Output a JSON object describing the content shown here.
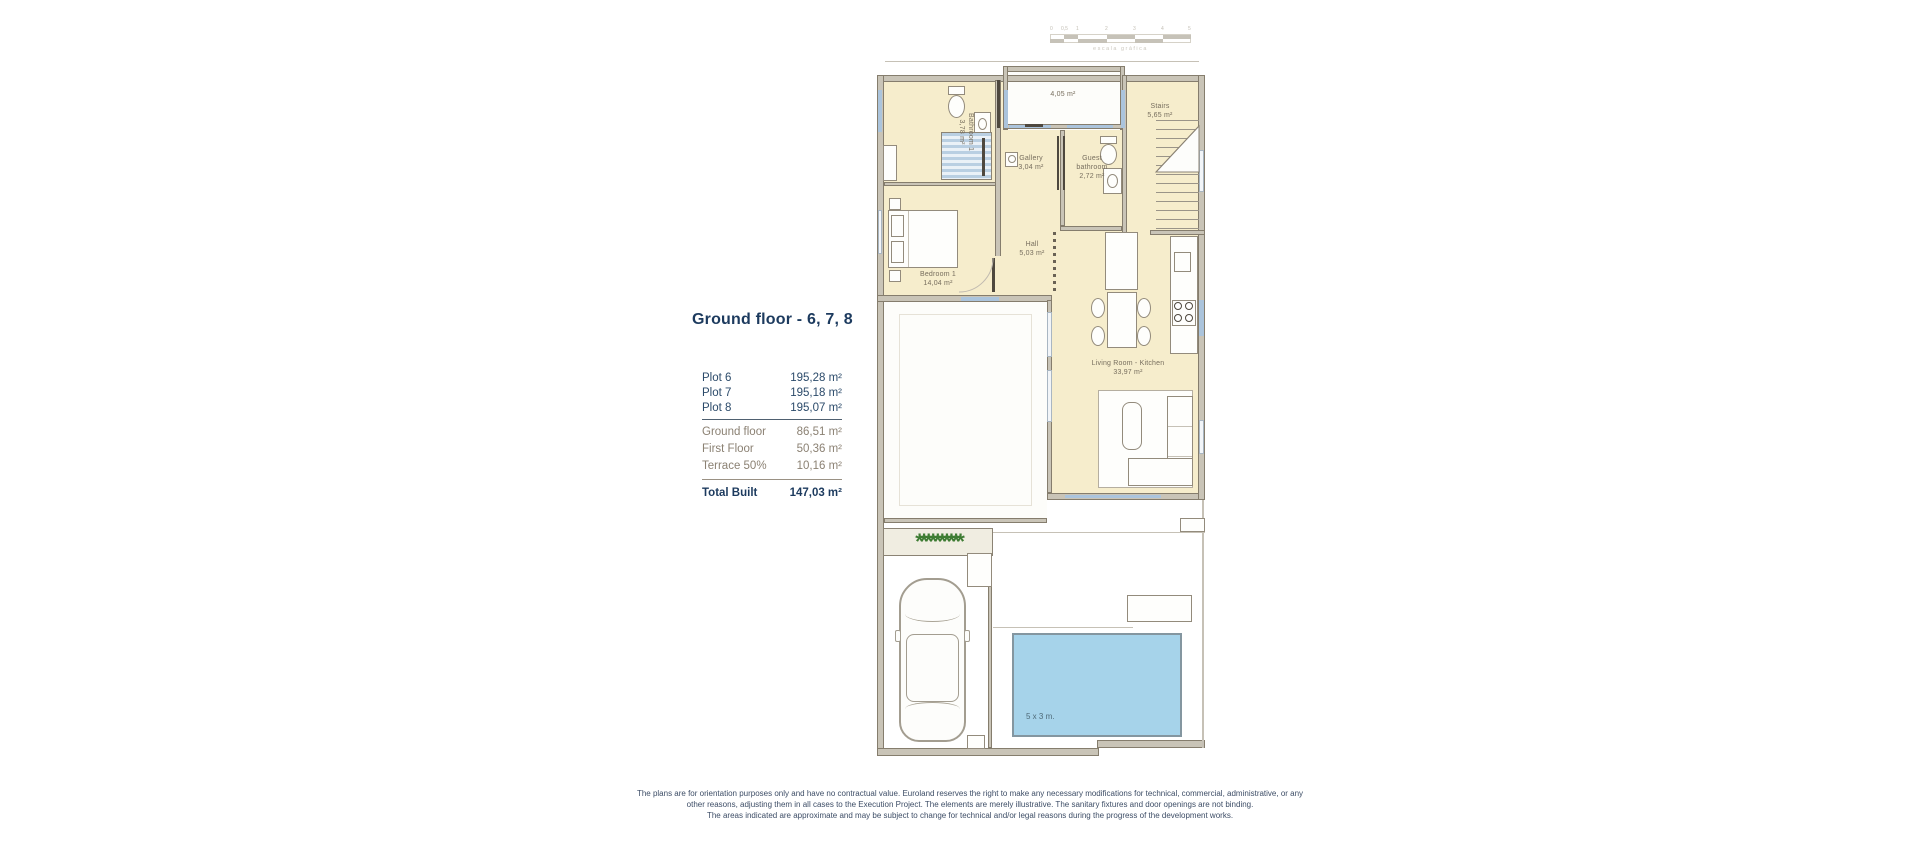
{
  "title": "Ground floor - 6, 7, 8",
  "area_table": {
    "plots": [
      {
        "label": "Plot 6",
        "value": "195,28 m²"
      },
      {
        "label": "Plot 7",
        "value": "195,18 m²"
      },
      {
        "label": "Plot 8",
        "value": "195,07 m²"
      }
    ],
    "breakdown": [
      {
        "label": "Ground floor",
        "value": "86,51 m²"
      },
      {
        "label": "First Floor",
        "value": "50,36 m²"
      },
      {
        "label": "Terrace 50%",
        "value": "10,16 m²"
      }
    ],
    "total_label": "Total Built",
    "total_value": "147,03 m²"
  },
  "plan": {
    "rooms": {
      "bathroom1": {
        "name": "Bathroom 1",
        "area": "3,78 m²"
      },
      "top_terrace": {
        "area": "4,05 m²"
      },
      "stairs": {
        "name": "Stairs",
        "area": "5,65 m²"
      },
      "gallery": {
        "name": "Gallery",
        "area": "3,04 m²"
      },
      "guest_bathroom": {
        "name": "Guest bathroom",
        "area": "2,72 m²"
      },
      "hall": {
        "name": "Hall",
        "area": "5,03 m²"
      },
      "bedroom1": {
        "name": "Bedroom 1",
        "area": "14,04 m²"
      },
      "living_kitchen": {
        "name": "Living Room - Kitchen",
        "area": "33,97 m²"
      }
    },
    "pool": {
      "label": "5 x 3 m."
    },
    "planter": {
      "glyph": "*"
    }
  },
  "scale_bar": {
    "ticks": [
      "0",
      "0,5",
      "1",
      "2",
      "3",
      "4",
      "5"
    ],
    "caption": "escala gráfica"
  },
  "disclaimer": {
    "line1": "The plans are for orientation purposes only and have no contractual value. Euroland reserves the right to make any necessary modifications for technical, commercial, administrative, or any",
    "line2": "other reasons, adjusting them in all cases to the Execution Project. The elements are merely illustrative. The sanitary fixtures and door openings are not binding.",
    "line3": "The areas indicated are approximate and may be subject to change for technical and/or legal reasons during the progress of the development works."
  },
  "colors": {
    "title_navy": "#1c3a5e",
    "table_gray": "#8b8173",
    "floor_cream": "#f6edcc",
    "wall_gray": "#c9c4b7",
    "window_blue": "#abc4dc",
    "pool_blue": "#a6d3ea",
    "plant_green": "#3e7c33",
    "disclaimer_blue": "#3d4d66"
  }
}
